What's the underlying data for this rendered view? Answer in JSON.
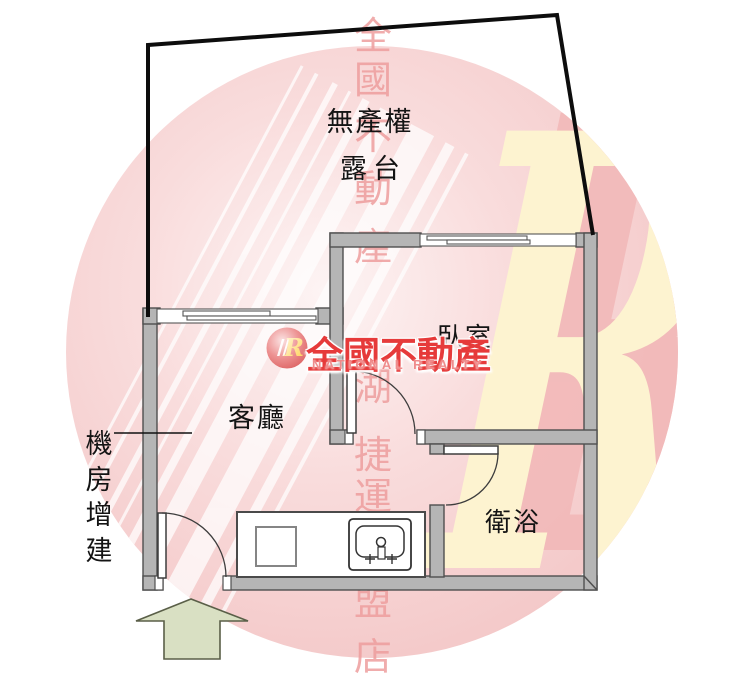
{
  "floorplan": {
    "labels": {
      "terrace_title": "無產權",
      "terrace_subtitle": "露台",
      "bedroom": "臥室",
      "living_room": "客廳",
      "bathroom": "衛浴",
      "annex": "機房增建"
    },
    "colors": {
      "wall_fill": "#b5b5b5",
      "wall_outline": "#4f4f4f",
      "terrace_boundary": "#0d0d0d",
      "arrow_fill": "#d9e0c3",
      "arrow_outline": "#5a5f48"
    }
  },
  "watermark": {
    "column_chars": [
      "全",
      "國",
      "不",
      "動",
      "產",
      "湖",
      "捷",
      "運",
      "盟",
      "店"
    ],
    "big_r": "R",
    "circle_color": "#f4c8c8",
    "big_r_color": "#fdf3d0",
    "char_color": "#ee9e9e",
    "logo": {
      "r": "R",
      "brand": "全國不動產",
      "brand_en": "NATIONAL REALTY",
      "brand_color": "#e63a3a",
      "sub_color": "#ef8c8c"
    }
  }
}
